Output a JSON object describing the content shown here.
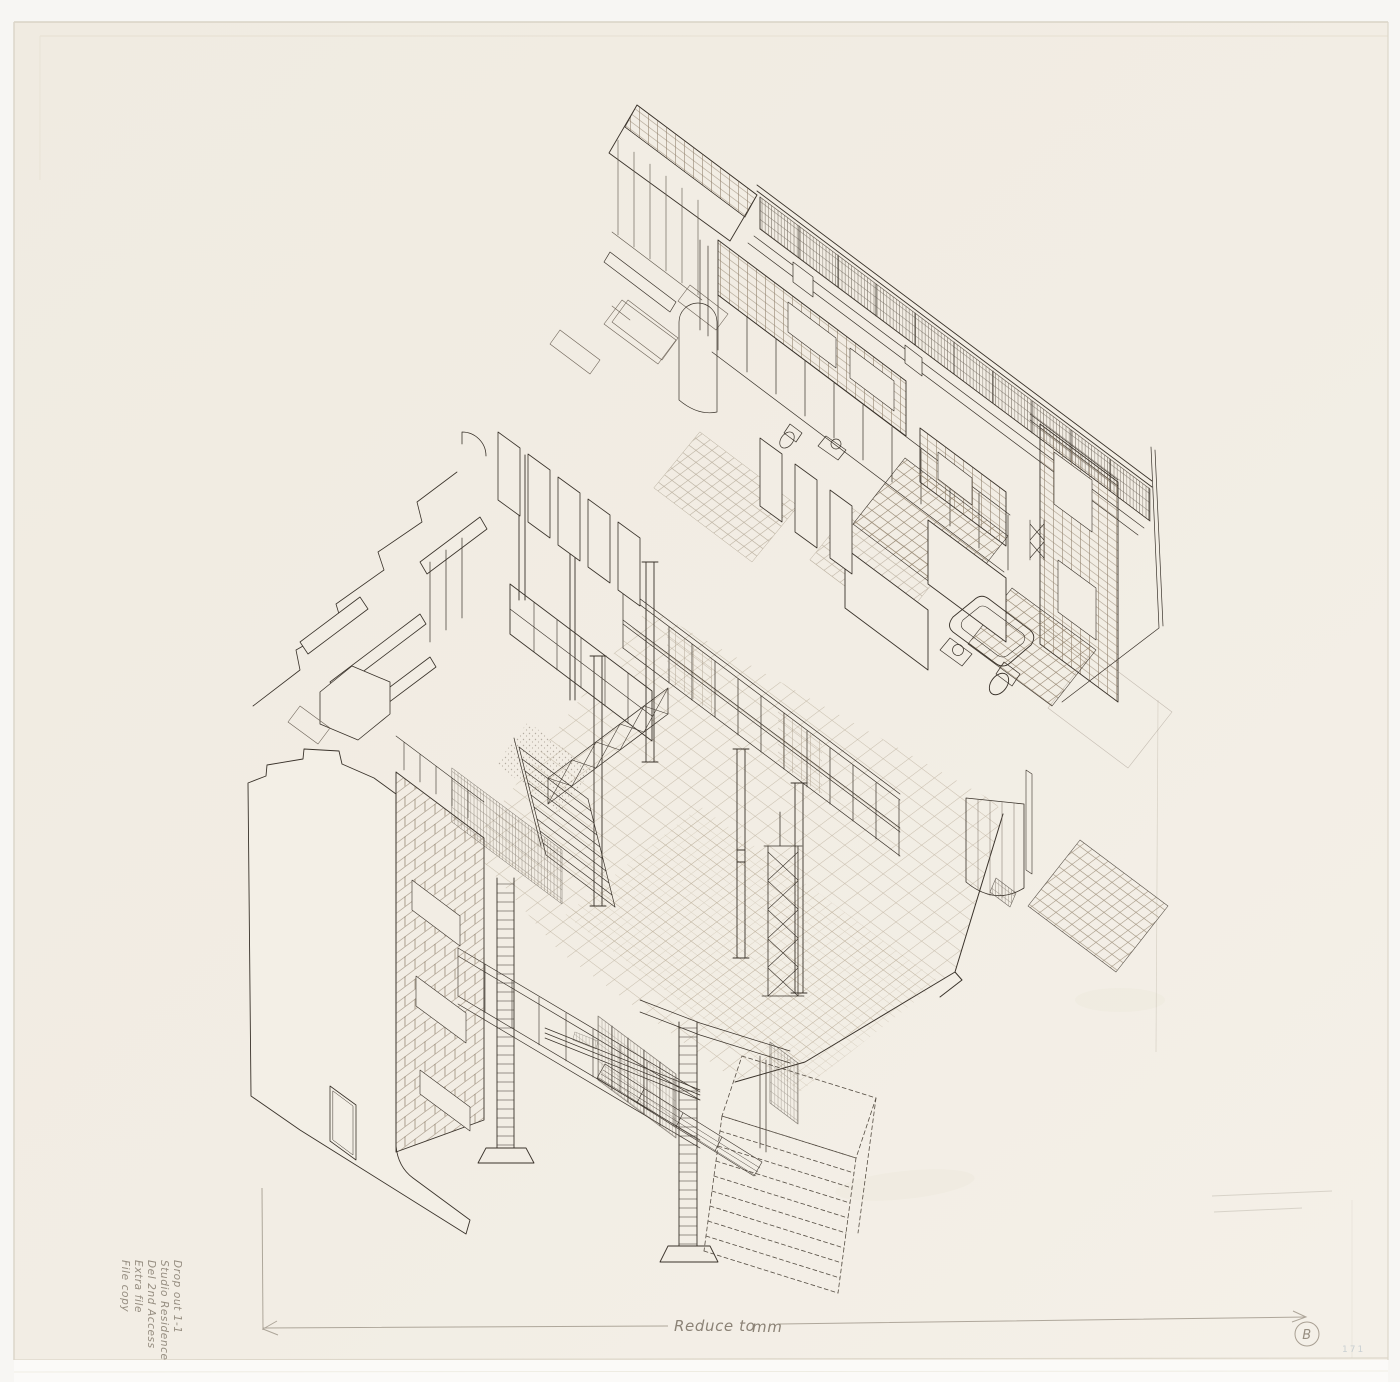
{
  "sheet": {
    "mark": "B",
    "stamp": "171"
  },
  "annotations": {
    "note_lines": [
      "Drop out 1-1",
      "Studio Residence",
      "Del 2nd Access",
      "Extra file",
      "File copy"
    ],
    "reduce_label": "Reduce to",
    "unit_label": "mm"
  },
  "colors": {
    "background": "#f6f5f2",
    "paper": "#f1ece3",
    "ink": "#39322a",
    "pencil": "#8d8477",
    "hatch_brick": "#7d6c55",
    "hatch_tile": "#9f8f76"
  }
}
